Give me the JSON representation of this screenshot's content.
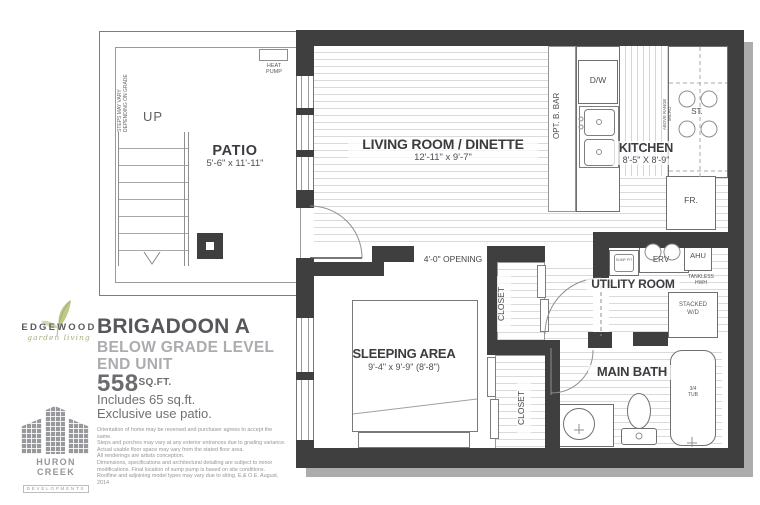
{
  "branding": {
    "edgewood_name": "EDGEWOOD",
    "edgewood_tagline": "garden living",
    "model_name": "BRIGADOON A",
    "subtitle_line1": "BELOW GRADE LEVEL",
    "subtitle_line2": "END UNIT",
    "area_value": "558",
    "area_unit": "SQ.FT.",
    "includes_line1": "Includes 65 sq.ft.",
    "includes_line2": "Exclusive use patio.",
    "developer_name": "HURON CREEK",
    "developer_sub": "DEVELOPMENTS",
    "disclaimer": [
      "Orientation of home may be reversed and purchaser agrees to accept the same.",
      "Steps and porches may vary at any exterior entrances due to grading variance.",
      "Actual usable floor space may vary from the stated floor area.",
      "All renderings are artists conception.",
      "Dimensions, specifications and architectural detailing are subject to minor",
      "modifications. Final location of sump pump is based on site conditions.",
      "Roofline and adjoining model types may vary due to siting. E.& O.E. August, 2014"
    ]
  },
  "plan": {
    "patio": {
      "label": "PATIO",
      "dim": "5'-6\" x 11'-11\"",
      "up": "UP",
      "steps_note": "STEPS MAY VARY\nDEPENDING ON GRADE",
      "heat_pump": "HEAT\nPUMP"
    },
    "living": {
      "label": "LIVING ROOM / DINETTE",
      "dim": "12'-11\" x 9'-7\""
    },
    "kitchen": {
      "label": "KITCHEN",
      "dim": "8'-5\" X 8'-9\"",
      "dishwasher": "D/W",
      "opt_bar": "OPT. B. BAR",
      "above_range": "ABOVE RANGE\nMICRO",
      "stove": "ST.",
      "fridge": "FR."
    },
    "opening_label": "4'-0\" OPENING",
    "sleeping": {
      "label": "SLEEPING AREA",
      "dim": "9'-4\" x 9'-9\" (8'-8\")"
    },
    "closet_upper": "CLOSET",
    "closet_lower": "CLOSET",
    "utility": {
      "label": "UTILITY ROOM",
      "erv": "ERV",
      "ahu": "AHU",
      "tankless": "TANKLESS\nHWH",
      "washer": "STACKED\nW/D",
      "sump": "SUMP PIT"
    },
    "bath": {
      "label": "MAIN BATH",
      "tub": "3/4\nTUB"
    }
  },
  "colors": {
    "wall": "#3f3f3f",
    "leaf": "#b9c27d",
    "developer_gray": "#97999c"
  }
}
